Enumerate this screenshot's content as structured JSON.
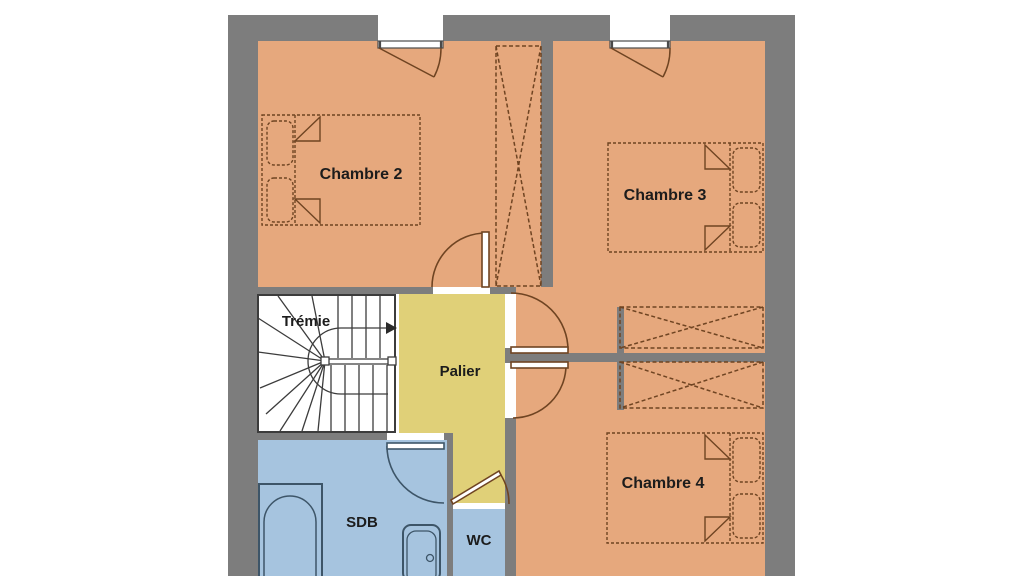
{
  "plan": {
    "rooms": {
      "chambre2": {
        "label": "Chambre 2"
      },
      "chambre3": {
        "label": "Chambre 3"
      },
      "chambre4": {
        "label": "Chambre 4"
      },
      "tremie": {
        "label": "Trémie"
      },
      "palier": {
        "label": "Palier"
      },
      "sdb": {
        "label": "SDB"
      },
      "wc": {
        "label": "WC"
      }
    },
    "colors": {
      "wall": "#7d7d7d",
      "bedroom": "#e6a87d",
      "landing": "#e0d078",
      "bath": "#a6c4df",
      "stair_floor": "#ffffff",
      "furniture_line": "#6f4422",
      "fixture_line": "#3d5568",
      "stair_line": "#3c3c3c",
      "opening": "#ffffff"
    }
  }
}
